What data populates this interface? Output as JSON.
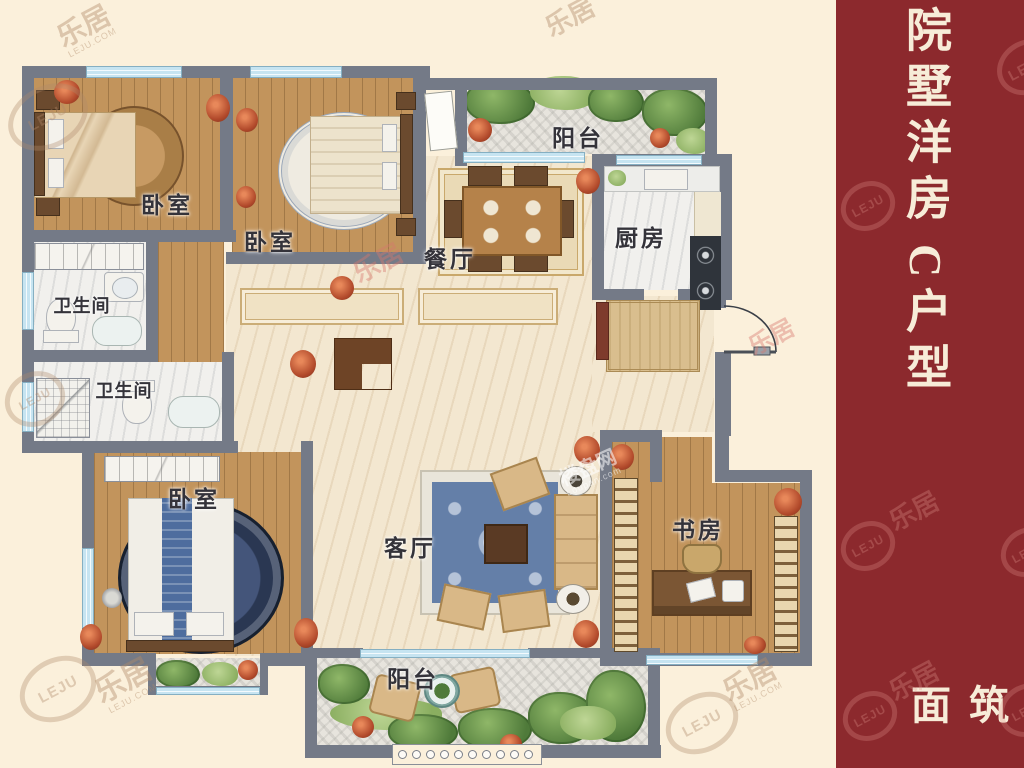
{
  "sidebar": {
    "title": "院墅洋房",
    "unit": "C户型",
    "bottom_text": "建筑面",
    "bg_color": "#8C292D",
    "text_color": "#F7ECD8"
  },
  "rooms": {
    "bedroom_top_left": "卧室",
    "bedroom_top_middle": "卧室",
    "bedroom_bottom_left": "卧室",
    "bathroom_upper": "卫生间",
    "bathroom_lower": "卫生间",
    "dining_room": "餐厅",
    "kitchen": "厨房",
    "living_room": "客厅",
    "study": "书房",
    "balcony_top": "阳台",
    "balcony_bottom": "阳台"
  },
  "watermarks": {
    "cn": "乐居",
    "en": "LEJU",
    "site": "LEJU.COM",
    "site_cn": "楼盘网",
    "site_en": "Loupan.com"
  },
  "colors": {
    "wall": "#747A87",
    "window": "#C6E4F1",
    "wood_floor": "#C2945C",
    "marble_floor": "#F3E7D0",
    "balcony_stone": "#E7E4DD",
    "greenery": "#4F7A3A"
  }
}
